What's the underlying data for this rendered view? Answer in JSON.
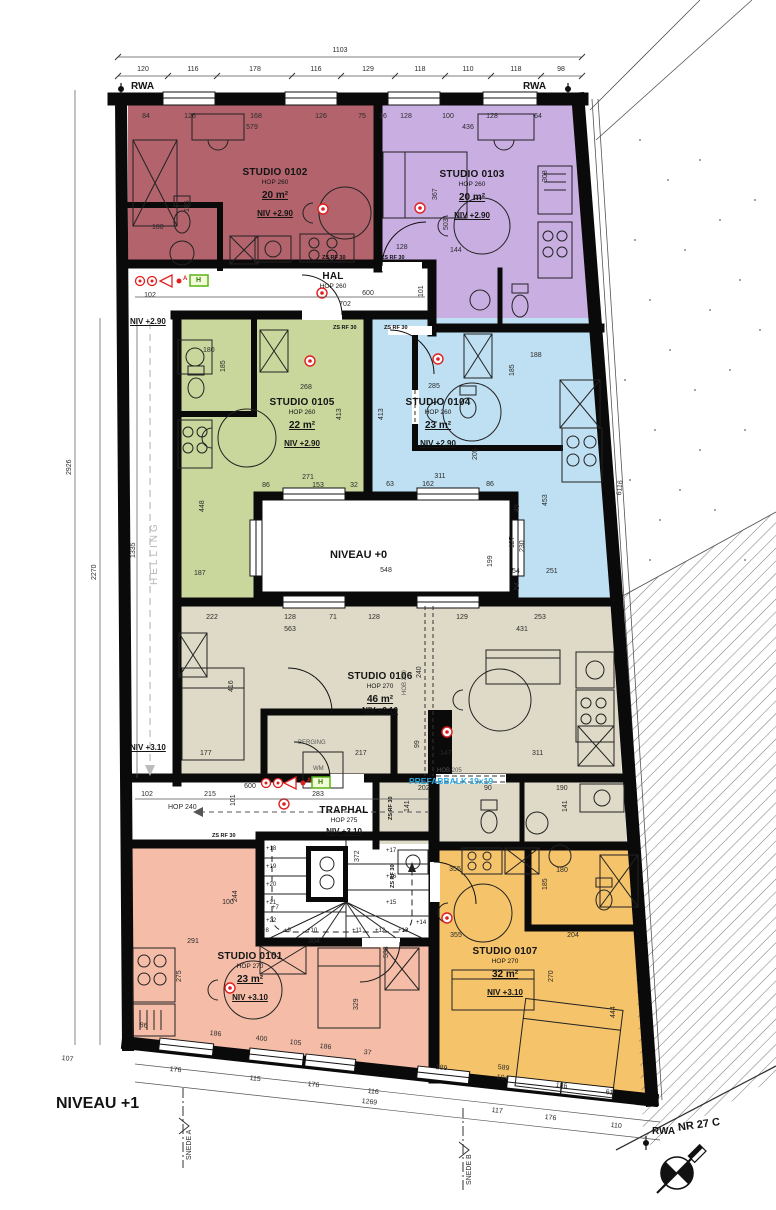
{
  "meta": {
    "title": "NIVEAU +1",
    "site": "NR 27 C",
    "rwa": "RWA",
    "snede_a": "SNEDE A",
    "snede_b": "SNEDE B",
    "prefab": "PREFABBALK 19x19",
    "helling": "HELLING",
    "hob250": "HOB 250",
    "hob205": "HOB 205",
    "zsrf": "ZS RF 30",
    "niv_290": "NIV +2.90",
    "niv_310": "NIV +3.10",
    "accent_blue": "#2ba7e0",
    "marker_red": "#e02020",
    "exit_green": "#58b312"
  },
  "rooms": {
    "s0101": {
      "name": "STUDIO 0101",
      "hop": "HOP 270",
      "area": "23 m²",
      "niv": "NIV +3.10",
      "color": "#f5bda8"
    },
    "s0102": {
      "name": "STUDIO 0102",
      "hop": "HOP 260",
      "area": "20 m²",
      "niv": "NIV +2.90",
      "color": "#b2636c"
    },
    "s0103": {
      "name": "STUDIO 0103",
      "hop": "HOP 260",
      "area": "20 m²",
      "niv": "NIV +2.90",
      "color": "#c9aee2"
    },
    "s0104": {
      "name": "STUDIO 0104",
      "hop": "HOP 260",
      "area": "23 m²",
      "niv": "NIV +2.90",
      "color": "#bfe0f2"
    },
    "s0105": {
      "name": "STUDIO 0105",
      "hop": "HOP 260",
      "area": "22 m²",
      "niv": "NIV +2.90",
      "color": "#cad79c"
    },
    "s0106": {
      "name": "STUDIO 0106",
      "hop": "HOP 270",
      "area": "46 m²",
      "niv": "NIV +3.10",
      "color": "#dedac7"
    },
    "s0107": {
      "name": "STUDIO 0107",
      "hop": "HOP 270",
      "area": "32 m²",
      "niv": "NIV +3.10",
      "color": "#f5c369"
    }
  },
  "corridors": {
    "hal": {
      "name": "HAL",
      "hop": "HOP 260"
    },
    "traphal": {
      "name": "TRAPHAL",
      "hop": "HOP 275",
      "niv": "NIV +3.10"
    },
    "gang": {
      "hop": "HOP 240"
    },
    "berging": {
      "name": "BERGING",
      "wm": "WM"
    },
    "void": {
      "name": "NIVEAU +0"
    }
  },
  "stairs": {
    "steps_left": [
      "+18",
      "+19",
      "+20",
      "+21",
      "+22"
    ],
    "steps_right": [
      "+17",
      "+16",
      "+15"
    ],
    "steps_bottom": [
      "+8",
      "+9",
      "+10",
      "+11",
      "+12",
      "+13",
      "+14"
    ],
    "step_first": "+7"
  },
  "icons": {
    "exit_h": "H",
    "alarm_a": "A"
  },
  "dims": {
    "top_total": "1103",
    "top": [
      "120",
      "116",
      "178",
      "116",
      "129",
      "118",
      "110",
      "118",
      "98"
    ],
    "left": [
      "2926",
      "2270",
      "1335"
    ],
    "right": "6116",
    "s0102": [
      "84",
      "126",
      "168",
      "126",
      "75",
      "579",
      "185",
      "180"
    ],
    "s0103": [
      "16",
      "128",
      "100",
      "128",
      "64",
      "436",
      "367",
      "503",
      "308",
      "144",
      "128"
    ],
    "hal": [
      "102",
      "600",
      "702",
      "101"
    ],
    "s0105": [
      "268",
      "413",
      "271",
      "86",
      "153",
      "32",
      "185",
      "448",
      "180",
      "187"
    ],
    "s0104": [
      "285",
      "413",
      "311",
      "63",
      "162",
      "86",
      "205",
      "185",
      "188",
      "453",
      "251",
      "54"
    ],
    "void": [
      "548",
      "199",
      "49",
      "127",
      "230",
      "54"
    ],
    "s0106": [
      "222",
      "128",
      "71",
      "128",
      "563",
      "416",
      "177",
      "217",
      "240",
      "99",
      "147",
      "311",
      "129",
      "253",
      "431"
    ],
    "bath": [
      "202",
      "90",
      "190",
      "141",
      "141"
    ],
    "trap": [
      "600",
      "102",
      "215",
      "283",
      "101",
      "372"
    ],
    "s0101": [
      "291",
      "275",
      "100",
      "244",
      "304",
      "329",
      "86",
      "186",
      "400",
      "105",
      "186",
      "37"
    ],
    "s0107": [
      "355",
      "180",
      "185",
      "204",
      "355",
      "270",
      "533",
      "444",
      "189",
      "589",
      "104",
      "186",
      "61"
    ],
    "bottom": [
      "107",
      "176",
      "115",
      "176",
      "116",
      "1269",
      "117",
      "176",
      "110"
    ]
  }
}
